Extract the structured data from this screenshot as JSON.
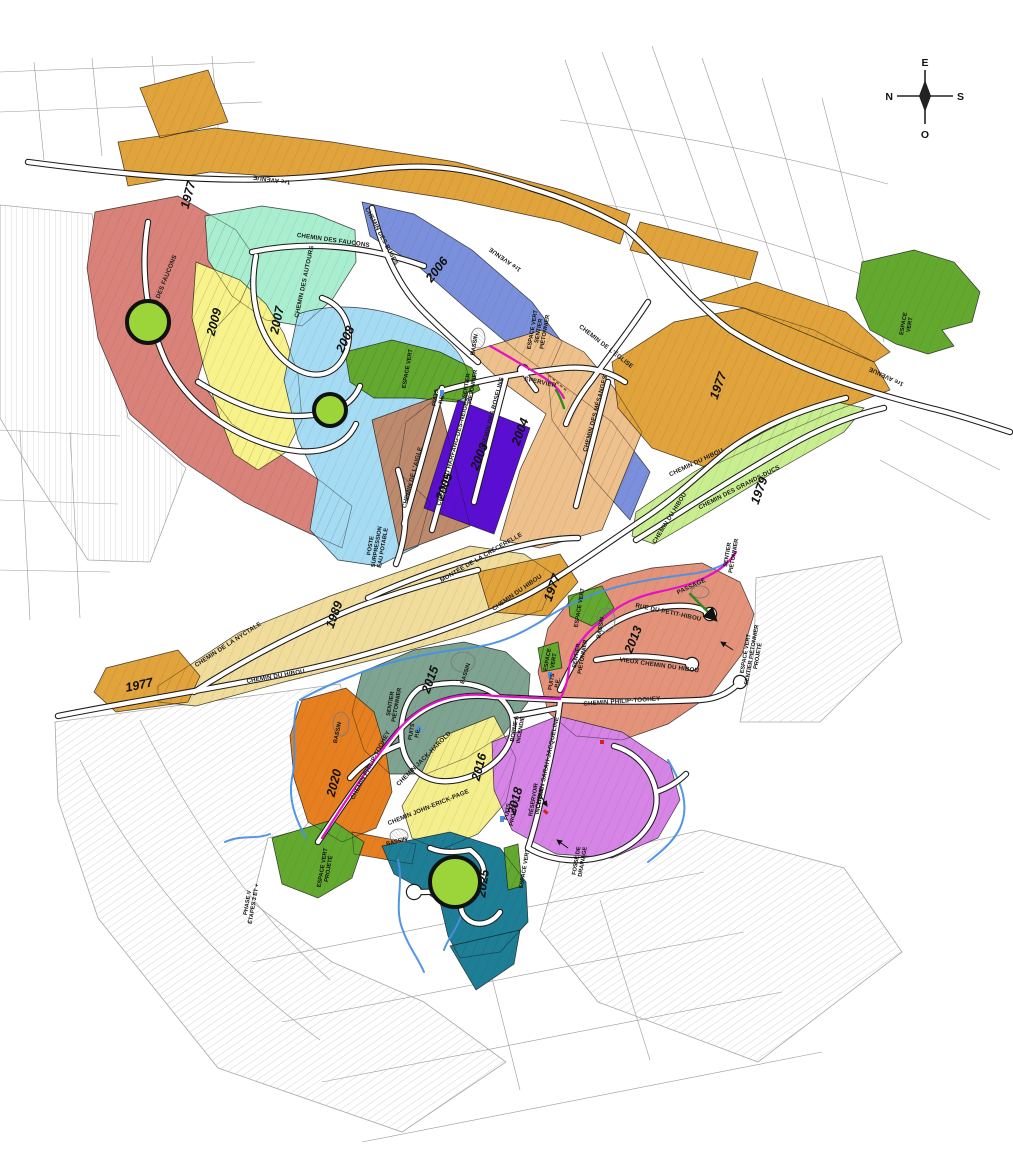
{
  "map": {
    "compass": {
      "top": "E",
      "left": "N",
      "right": "S",
      "bottom": "O"
    },
    "colors": {
      "road_fill": "#ffffff",
      "road_casing": "#1c1c1c",
      "stream": "#4a90e2",
      "trail": "#e312c8",
      "green_space": "#63a92f",
      "marker": "#9cd53a",
      "hatch": "#c2c2c2",
      "parcel_line": "#9a9a9a"
    },
    "zones": [
      {
        "id": "gold-top",
        "year": "1977",
        "color": "#e1a33b",
        "x": 192,
        "y": 196,
        "rot": -75
      },
      {
        "id": "gold-top-north",
        "year": "",
        "color": "#e1a33b"
      },
      {
        "id": "gold-top-east",
        "year": "",
        "color": "#e1a33b"
      },
      {
        "id": "rose",
        "year": "",
        "color": "#d9827a"
      },
      {
        "id": "mint-2007",
        "year": "2007",
        "color": "#a9eecf",
        "x": 281,
        "y": 321,
        "rot": -78
      },
      {
        "id": "yellow-2009",
        "year": "2009",
        "color": "#f7f28a",
        "x": 218,
        "y": 323,
        "rot": -75
      },
      {
        "id": "blue-2006",
        "year": "2006",
        "color": "#7b90dc",
        "x": 440,
        "y": 272,
        "rot": -52
      },
      {
        "id": "blue-2006-tail",
        "year": "",
        "color": "#7b90dc"
      },
      {
        "id": "lblue-2008",
        "year": "2008",
        "color": "#a5dcf4",
        "x": 349,
        "y": 341,
        "rot": -65
      },
      {
        "id": "green-top",
        "year": "",
        "color": "#63a92f"
      },
      {
        "id": "brown-2005",
        "year": "2005",
        "color": "#bd8a6e",
        "x": 448,
        "y": 488,
        "rot": -70
      },
      {
        "id": "purple-2003",
        "year": "2003",
        "color": "#5a0ed2",
        "x": 483,
        "y": 458,
        "rot": -68
      },
      {
        "id": "tan-2004",
        "year": "2004",
        "color": "#eec08b",
        "x": 524,
        "y": 433,
        "rot": -70
      },
      {
        "id": "gold-right",
        "year": "1977",
        "color": "#e1a33b",
        "x": 722,
        "y": 387,
        "rot": -70
      },
      {
        "id": "gold-right2",
        "year": "",
        "color": "#e1a33b"
      },
      {
        "id": "lgreen-1979",
        "year": "1979",
        "color": "#c9ee90",
        "x": 763,
        "y": 492,
        "rot": -70
      },
      {
        "id": "green-right",
        "year": "",
        "color": "#63a92f"
      },
      {
        "id": "paleyellow-1989",
        "year": "1989",
        "color": "#f0dc9b",
        "x": 338,
        "y": 616,
        "rot": -70
      },
      {
        "id": "gold-bl",
        "year": "1977",
        "color": "#e1a33b",
        "x": 140,
        "y": 689,
        "rot": -12
      },
      {
        "id": "gold-center",
        "year": "1977",
        "color": "#e1a33b",
        "x": 556,
        "y": 589,
        "rot": -70
      },
      {
        "id": "salmon-2013",
        "year": "2013",
        "color": "#e4937b",
        "x": 637,
        "y": 641,
        "rot": -68
      },
      {
        "id": "sage-2015",
        "year": "2015",
        "color": "#7ea391",
        "x": 434,
        "y": 681,
        "rot": -70
      },
      {
        "id": "yellow-2016",
        "year": "2016",
        "color": "#f4ef8c",
        "x": 483,
        "y": 768,
        "rot": -75
      },
      {
        "id": "orchid-2018",
        "year": "2018",
        "color": "#d685e6",
        "x": 519,
        "y": 802,
        "rot": -75
      },
      {
        "id": "orange-2020",
        "year": "2020",
        "color": "#e67f20",
        "x": 338,
        "y": 784,
        "rot": -75
      },
      {
        "id": "orange-2020b",
        "year": "",
        "color": "#e67f20"
      },
      {
        "id": "teal-2025",
        "year": "2025",
        "color": "#1d7e96",
        "x": 487,
        "y": 884,
        "rot": -82
      },
      {
        "id": "teal-2025-tail",
        "year": "",
        "color": "#1d7e96"
      },
      {
        "id": "green-bl",
        "year": "",
        "color": "#63a92f"
      },
      {
        "id": "green-2013a",
        "year": "",
        "color": "#63a92f"
      },
      {
        "id": "green-2013b",
        "year": "",
        "color": "#63a92f"
      },
      {
        "id": "green-2018s",
        "year": "",
        "color": "#63a92f"
      }
    ],
    "streets": [
      {
        "name": "1re AVENUE",
        "x": 272,
        "y": 178,
        "rot": 188
      },
      {
        "name": "1re AVENUE",
        "x": 506,
        "y": 258,
        "rot": 215
      },
      {
        "name": "1re AVENUE",
        "x": 887,
        "y": 375,
        "rot": 205
      },
      {
        "name": "CHEMIN DES FAUCONS",
        "x": 163,
        "y": 290,
        "rot": -68
      },
      {
        "name": "CHEMIN DES FAUCONS",
        "x": 333,
        "y": 242,
        "rot": 8
      },
      {
        "name": "CHEMIN DES AUTOURS",
        "x": 306,
        "y": 282,
        "rot": -78
      },
      {
        "name": "CHEMIN DES BUSES",
        "x": 380,
        "y": 237,
        "rot": 62
      },
      {
        "name": "CHEMIN DU HARFANG-DES-NEIGES",
        "x": 455,
        "y": 452,
        "rot": -75
      },
      {
        "name": "CHEMIN DE L'AIGLE",
        "x": 414,
        "y": 478,
        "rot": -75
      },
      {
        "name": "CHEMIN DES ROSELINS",
        "x": 494,
        "y": 414,
        "rot": -75
      },
      {
        "name": "CHEMIN DES MÉSANGES",
        "x": 597,
        "y": 414,
        "rot": -75
      },
      {
        "name": "ÉPERVIER",
        "x": 540,
        "y": 384,
        "rot": 12
      },
      {
        "name": "CHEMIN DE L'ÉGLISE",
        "x": 605,
        "y": 348,
        "rot": 38
      },
      {
        "name": "CHEMIN DU HIBOU",
        "x": 697,
        "y": 464,
        "rot": -25
      },
      {
        "name": "CHEMIN DES GRANDS-DUCS",
        "x": 740,
        "y": 489,
        "rot": -27
      },
      {
        "name": "CHEMIN DU HIBOU",
        "x": 671,
        "y": 519,
        "rot": -58
      },
      {
        "name": "CHEMIN DU HIBOU",
        "x": 276,
        "y": 678,
        "rot": -10
      },
      {
        "name": "CHEMIN DU HIBOU",
        "x": 518,
        "y": 594,
        "rot": -35
      },
      {
        "name": "CHEMIN DE LA NYCTALE",
        "x": 229,
        "y": 646,
        "rot": -33
      },
      {
        "name": "MONTÉE DE LA CRÉCERELLE",
        "x": 482,
        "y": 559,
        "rot": -30
      },
      {
        "name": "CHEMIN PHILIP-TOOHEY",
        "x": 622,
        "y": 703,
        "rot": -4
      },
      {
        "name": "CHEMIN PHILIP-TOOHEY",
        "x": 372,
        "y": 766,
        "rot": -62
      },
      {
        "name": "CHEMIN JACK-HAROLD",
        "x": 425,
        "y": 760,
        "rot": -45
      },
      {
        "name": "CHEMIN JOHN-ERICK-PAGE",
        "x": 429,
        "y": 809,
        "rot": -22
      },
      {
        "name": "CHEMIN SARAH-JACQUELINE",
        "x": 549,
        "y": 763,
        "rot": -78
      },
      {
        "name": "RUE DU PETIT-HIBOU",
        "x": 668,
        "y": 614,
        "rot": 12
      },
      {
        "name": "VIEUX CHEMIN DU HIBOU",
        "x": 659,
        "y": 667,
        "rot": 8
      },
      {
        "name": "PASSAGE",
        "x": 692,
        "y": 588,
        "rot": -25
      }
    ],
    "annotations": [
      {
        "text": "ESPACE VERT",
        "x": 409,
        "y": 369,
        "rot": -80
      },
      {
        "text": "BASSIN",
        "x": 476,
        "y": 345,
        "rot": -80
      },
      {
        "text": "PUITS\nP.E.",
        "x": 437,
        "y": 398,
        "rot": -80
      },
      {
        "text": "SENTIER\nPIÉTONNIER",
        "x": 468,
        "y": 386,
        "rot": -80
      },
      {
        "text": "ESPACE VERT\nSENTIER\nPIÉTONNIER",
        "x": 534,
        "y": 330,
        "rot": -80
      },
      {
        "text": "ESPACE\nVERT",
        "x": 905,
        "y": 324,
        "rot": -80
      },
      {
        "text": "POSTE\nSURPRESSION\nEAU POTABLE",
        "x": 372,
        "y": 546,
        "rot": -80
      },
      {
        "text": "SENTIER\nPIÉTONNIER",
        "x": 729,
        "y": 555,
        "rot": -80
      },
      {
        "text": "ESPACE VERT",
        "x": 581,
        "y": 608,
        "rot": -80
      },
      {
        "text": "BASSIN",
        "x": 602,
        "y": 628,
        "rot": -80
      },
      {
        "text": "ESPACE VERT\nSENTIER PIÉTONNIER\nPROJETÉ",
        "x": 747,
        "y": 654,
        "rot": -80
      },
      {
        "text": "SENTIER\nPIÉTONNIER",
        "x": 578,
        "y": 656,
        "rot": -80
      },
      {
        "text": "ESPACE\nVERT",
        "x": 549,
        "y": 660,
        "rot": -80
      },
      {
        "text": "PUITS\nP.E.",
        "x": 553,
        "y": 682,
        "rot": -80
      },
      {
        "text": "SENTIER\nPIÉTONNIER",
        "x": 392,
        "y": 704,
        "rot": -80
      },
      {
        "text": "PUITS\nP.E.",
        "x": 413,
        "y": 732,
        "rot": -80
      },
      {
        "text": "BASSIN",
        "x": 467,
        "y": 674,
        "rot": -72
      },
      {
        "text": "BASSIN",
        "x": 339,
        "y": 733,
        "rot": -78
      },
      {
        "text": "BORNE À\nINCENDIE",
        "x": 516,
        "y": 729,
        "rot": -80
      },
      {
        "text": "RÉSERVOIR\nINCENDIE",
        "x": 535,
        "y": 800,
        "rot": -80
      },
      {
        "text": "PUITS\nPROJETÉ",
        "x": 509,
        "y": 812,
        "rot": -80
      },
      {
        "text": "ESPACE VERT",
        "x": 526,
        "y": 869,
        "rot": -80
      },
      {
        "text": "FOSSÉ DE\nDRAINAGE",
        "x": 578,
        "y": 861,
        "rot": -80
      },
      {
        "text": "ESPACE VERT\nPROJETÉ",
        "x": 324,
        "y": 868,
        "rot": -80
      },
      {
        "text": "BASSIN",
        "x": 397,
        "y": 843,
        "rot": -14
      },
      {
        "text": "PHASE V\nÉTAPES 3 ET +",
        "x": 249,
        "y": 903,
        "rot": -80
      }
    ],
    "markers": [
      {
        "x": 148,
        "y": 322,
        "r": 21
      },
      {
        "x": 330,
        "y": 410,
        "r": 16
      },
      {
        "x": 455,
        "y": 882,
        "r": 25
      }
    ]
  }
}
